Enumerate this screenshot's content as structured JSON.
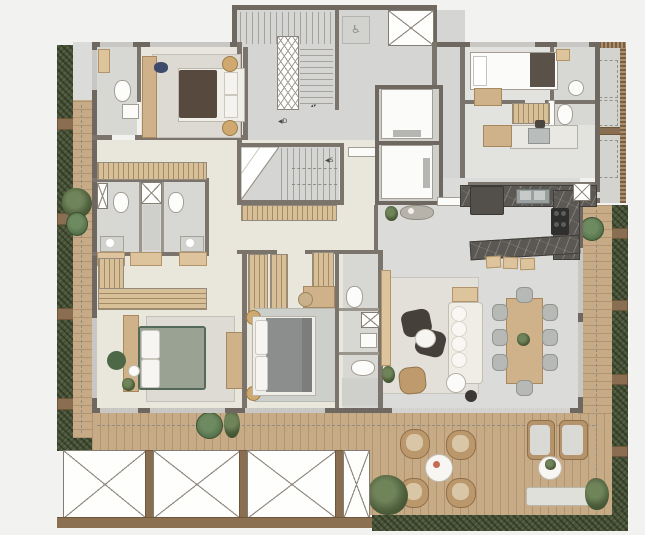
{
  "meta": {
    "title": "Apartment floor plan (top-down render)",
    "canvas": {
      "width": 645,
      "height": 535
    }
  },
  "labels": {
    "stair_down": "◀D",
    "stair_up": "◀S",
    "accessibility_symbol": "♿",
    "elevator_call_symbol": "▴▾"
  },
  "icons": [
    "wheelchair-icon",
    "shaft-x-icon",
    "void-bay-x-icon",
    "stair-direction-icon",
    "plant-icon"
  ],
  "palette": {
    "background": "#f2f2f1",
    "wall": "#6f6861",
    "floor_cool_gray": "#dbdcd9",
    "floor_warm_beige": "#e9e6db",
    "floor_bath": "#d7d7d4",
    "deck_wood": "#c7aa86",
    "hedge_green": "#49533a",
    "planter_brown": "#8a6e51",
    "closet_wood": "#d7bf98",
    "kitchen_marble": "#5b5853",
    "accent_bed_green": "#99a294",
    "accent_pouf_green": "#55724b"
  },
  "counts": {
    "void_bays_with_x": 4,
    "elevators": 2,
    "stair_flights": 2,
    "bedrooms": 4,
    "bathrooms": 6,
    "dining_chairs": 8,
    "bar_stools": 3,
    "terrace_armchairs": 4,
    "lounge_chairs": 2
  }
}
